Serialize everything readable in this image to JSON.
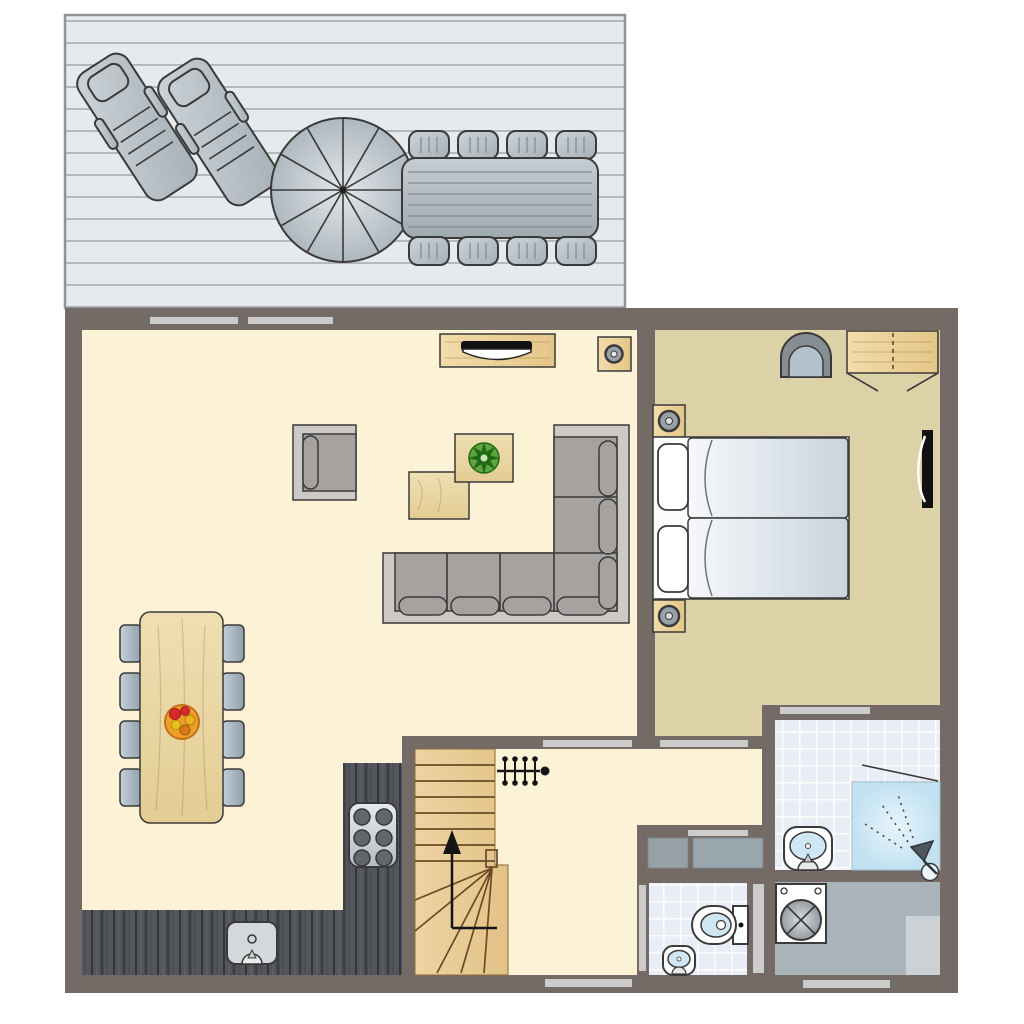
{
  "colors": {
    "wall": "#756b66",
    "floorLiving": "#fcf2d5",
    "floorBedroom": "#ddd1a8",
    "tileFloor": "#e9edf5",
    "tileLine": "#ffffff",
    "utilityFloor": "#a9b3ba",
    "counter": "#53565b",
    "doorBar": "#cccccc",
    "sofaSeat": "#a5a2a0",
    "sofaFrame": "#cdcac6",
    "outline": "#3a3a3a",
    "deckBase": "#e7eaec",
    "deckLine": "#b4b9bd",
    "deckBorder": "#8f9499",
    "outdoorSlat": "#8b949a",
    "fixtureBlue": "#cfe6f3",
    "stairLine": "#6b4a28",
    "closetGray1": "#97a1a8",
    "closetGray2": "#9aa6ad",
    "matGray": "#ccd1d6",
    "plantGreen": "#1f6b15",
    "fruitOrange": "#ef9f27"
  },
  "plan": {
    "type": "floor-plan",
    "outdoor": {
      "name": "deck",
      "furniture": [
        "sun-lounger",
        "sun-lounger",
        "parasol",
        "outdoor-dining-table",
        "outdoor-chair x8"
      ]
    },
    "rooms": [
      {
        "name": "living-room",
        "furniture": [
          "tv-cabinet",
          "tv",
          "speaker",
          "armchair",
          "coffee-table",
          "plant-table",
          "potted-plant",
          "corner-sofa",
          "dining-table",
          "fruit-bowl",
          "dining-chair x8"
        ]
      },
      {
        "name": "kitchen",
        "furniture": [
          "counter-l-shape",
          "sink",
          "stove-6-burner"
        ]
      },
      {
        "name": "hall",
        "furniture": [
          "stairs-up",
          "coat-rack",
          "storage-closet x2"
        ]
      },
      {
        "name": "bedroom",
        "furniture": [
          "double-bed",
          "pillow x2",
          "nightstand-with-lamp x2",
          "tub-chair",
          "wardrobe",
          "wall-tv"
        ]
      },
      {
        "name": "bathroom",
        "furniture": [
          "washbasin",
          "shower",
          "shower-head"
        ]
      },
      {
        "name": "wc",
        "furniture": [
          "toilet",
          "corner-washbasin"
        ]
      },
      {
        "name": "utility-room",
        "furniture": [
          "washing-machine",
          "floor-mat"
        ]
      }
    ],
    "openings": [
      "window-top-1",
      "window-top-2",
      "door-living-hall",
      "door-bedroom-hall",
      "door-bedroom-bathroom",
      "door-closet",
      "door-wc",
      "door-wc-utility",
      "front-door",
      "utility-exterior-door"
    ]
  }
}
